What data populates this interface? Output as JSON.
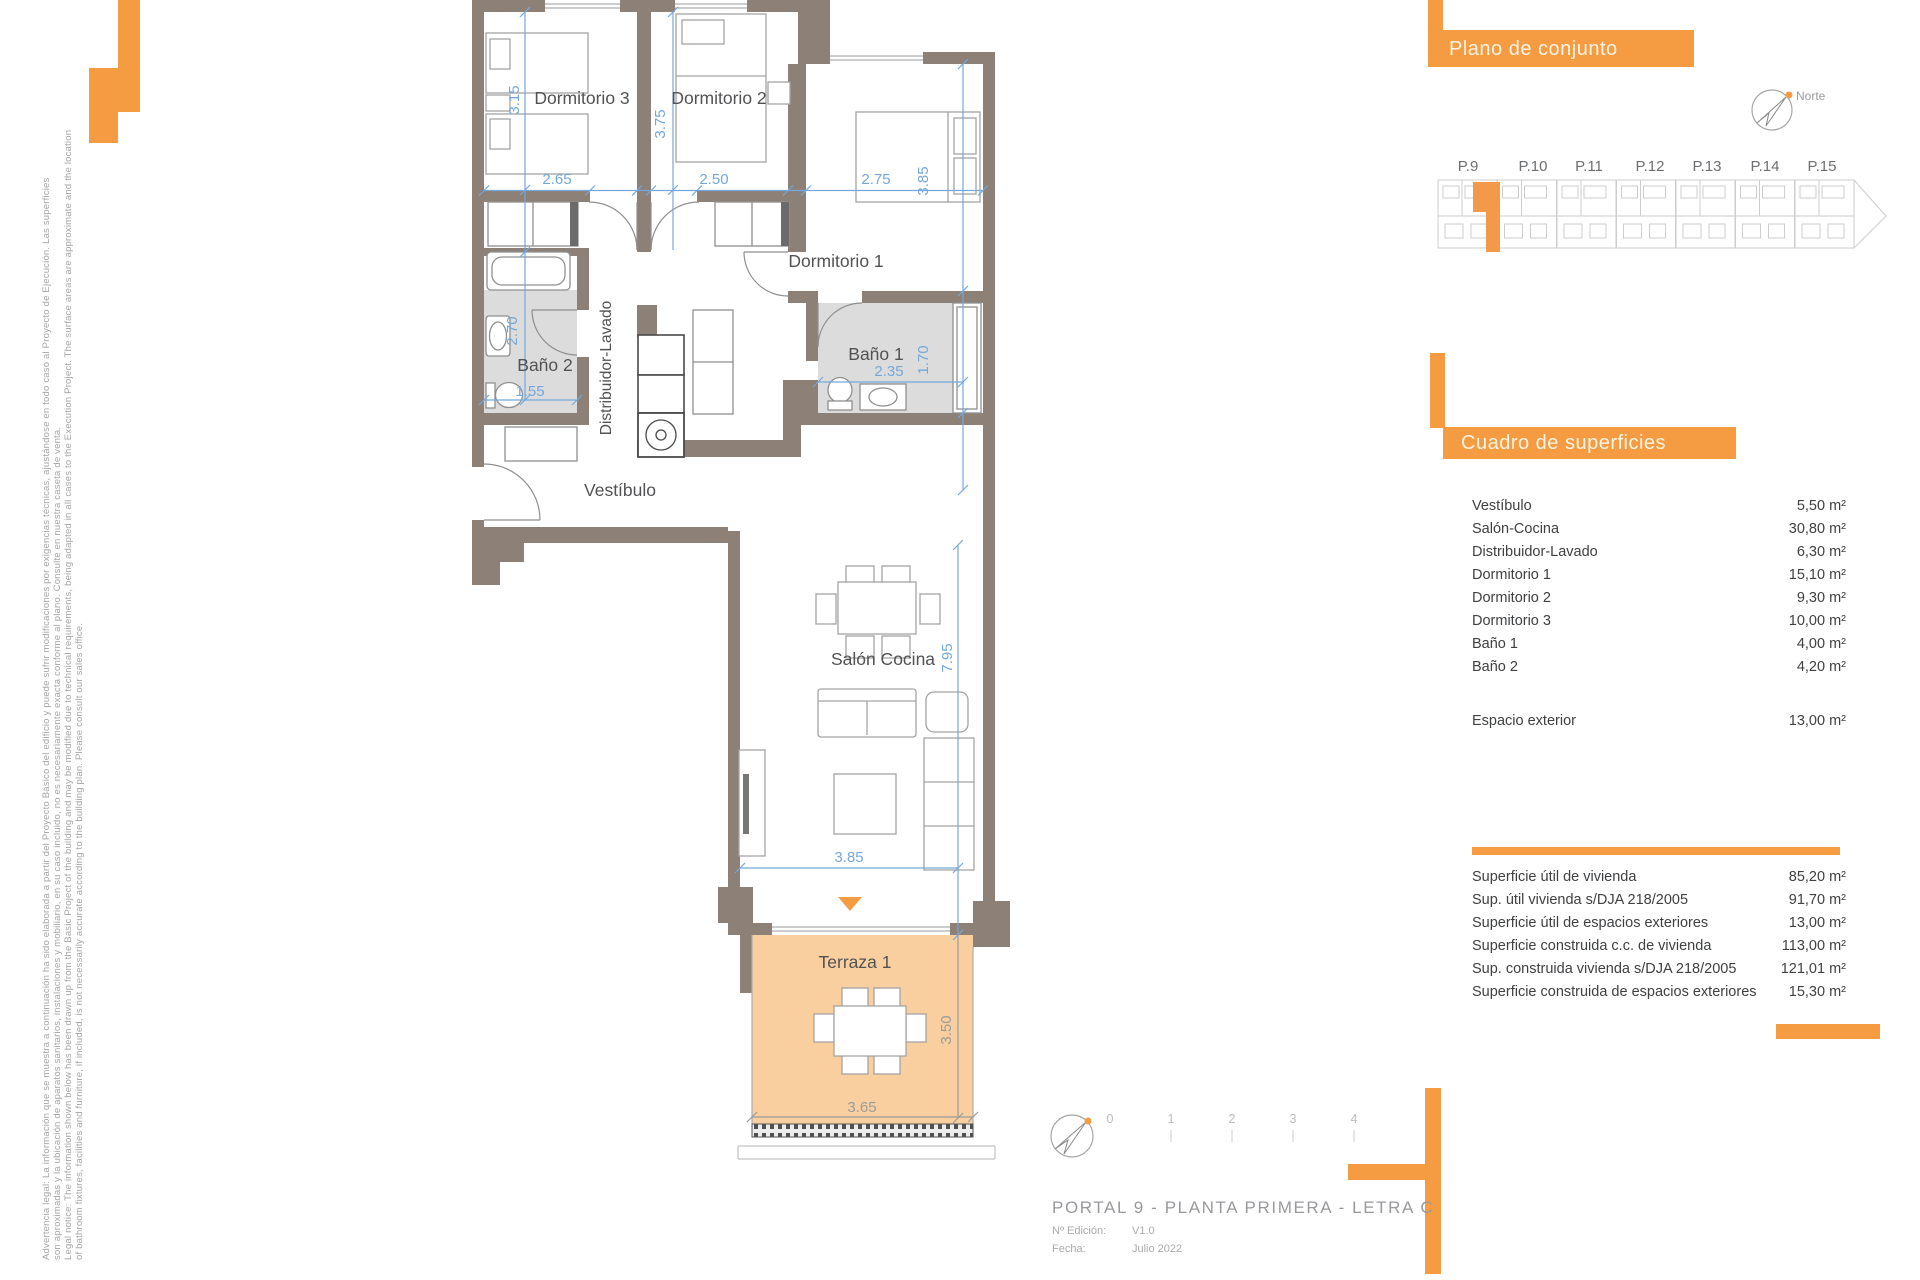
{
  "colors": {
    "orange": "#F59B42",
    "site_highlight": "#F2994A",
    "wall": "#8C8077",
    "terrace_floor": "#F9CFA0",
    "bath_floor": "#DCDCDC",
    "dim_blue": "#74A8DB"
  },
  "legal": {
    "lines": [
      "Advertencia legal: La información que se muestra a continuación ha sido elaborada a partir del Proyecto Básico del edificio y puede sufrir modificaciones por exigencias técnicas, ajustándose en todo caso al Proyecto de Ejecución. Las superficies",
      "son aproximadas y la ubicación de aparatos sanitarios, instalaciones y mobiliario, en su caso incluido, no es necesariamente exacta conforme al plano. Consulte en nuestra caseta de venta.",
      "Legal notice: The information shown below has been drawn up from the Basic Project of the building and may be modified due to technical requirements, being adapted in all cases to the Execution Project. The surface areas are approximate and the location",
      "of bathroom fixtures, facilities and furniture, if included, is not necessarily accurate according to the building plan. Please consult our sales office."
    ]
  },
  "plan": {
    "rooms": {
      "dormitorio3": "Dormitorio 3",
      "dormitorio2": "Dormitorio 2",
      "dormitorio1": "Dormitorio 1",
      "bano2": "Baño 2",
      "bano1": "Baño 1",
      "distribuidor": "Distribuidor-Lavado",
      "vestibulo": "Vestíbulo",
      "salon": "Salón Cocina",
      "terraza": "Terraza 1"
    },
    "dims": {
      "d3_w": "2.65",
      "d3_h": "3.15",
      "d2_w": "2.50",
      "d2_h": "3.75",
      "d1_w": "2.75",
      "d1_h": "3.85",
      "b2_h": "2.70",
      "b2_w": "1.55",
      "b1_w": "2.35",
      "b1_h": "1.70",
      "salon_h": "7.95",
      "salon_w": "3.85",
      "terraza_w": "3.65",
      "terraza_h": "3.50"
    }
  },
  "plano_conjunto": {
    "header": "Plano de conjunto",
    "north_label": "Norte",
    "buildings": [
      "P.9",
      "P.10",
      "P.11",
      "P.12",
      "P.13",
      "P.14",
      "P.15"
    ]
  },
  "cuadro": {
    "header": "Cuadro de superficies",
    "rows": [
      {
        "label": "Vestíbulo",
        "value": "5,50 m²"
      },
      {
        "label": "Salón-Cocina",
        "value": "30,80 m²"
      },
      {
        "label": "Distribuidor-Lavado",
        "value": "6,30 m²"
      },
      {
        "label": "Dormitorio 1",
        "value": "15,10 m²"
      },
      {
        "label": "Dormitorio 2",
        "value": "9,30 m²"
      },
      {
        "label": "Dormitorio 3",
        "value": "10,00 m²"
      },
      {
        "label": "Baño 1",
        "value": "4,00 m²"
      },
      {
        "label": "Baño 2",
        "value": "4,20 m²"
      }
    ],
    "exterior": {
      "label": "Espacio exterior",
      "value": "13,00 m²"
    },
    "summary": [
      {
        "label": "Superficie útil de vivienda",
        "value": "85,20 m²"
      },
      {
        "label": "Sup. útil vivienda s/DJA 218/2005",
        "value": "91,70 m²"
      },
      {
        "label": "Superficie útil de espacios exteriores",
        "value": "13,00 m²"
      },
      {
        "label": "Superficie construida c.c. de vivienda",
        "value": "113,00 m²"
      },
      {
        "label": "Sup. construida vivienda s/DJA 218/2005",
        "value": "121,01 m²"
      },
      {
        "label": "Superficie construida de espacios exteriores",
        "value": "15,30 m²"
      }
    ]
  },
  "scale": {
    "labels": [
      "0",
      "1",
      "2",
      "3",
      "4"
    ]
  },
  "title_block": {
    "title": "PORTAL 9 - PLANTA PRIMERA - LETRA C",
    "edition_label": "Nº Edición:",
    "edition_value": "V1.0",
    "date_label": "Fecha:",
    "date_value": "Julio 2022"
  }
}
